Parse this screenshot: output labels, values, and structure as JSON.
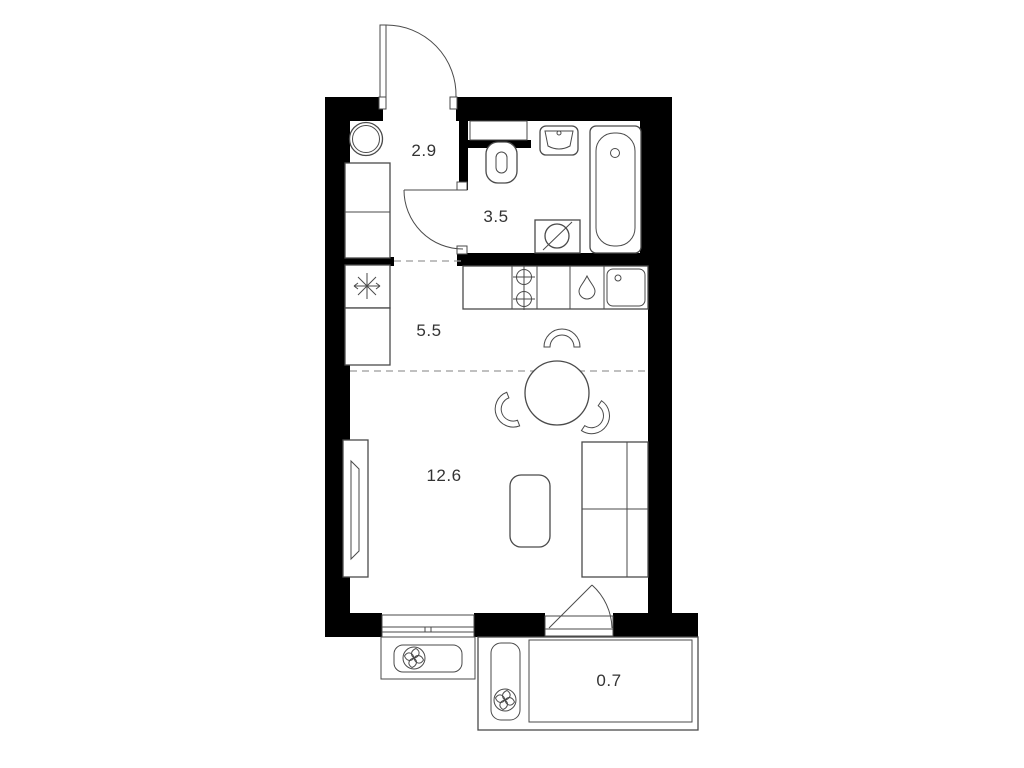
{
  "plan": {
    "rooms": [
      {
        "name": "hallway",
        "area": "2.9"
      },
      {
        "name": "bathroom",
        "area": "3.5"
      },
      {
        "name": "kitchen",
        "area": "5.5"
      },
      {
        "name": "living-room",
        "area": "12.6"
      },
      {
        "name": "balcony",
        "area": "0.7"
      }
    ],
    "colors": {
      "wall": "#000000",
      "line": "#4a4a4a",
      "dash": "#9a9a9a",
      "label": "#333333",
      "bg": "#ffffff"
    },
    "icons": {
      "refrigerator": "snowflake-icon",
      "air_conditioner": "fan-icon",
      "stove": "burner-crosshair-icon",
      "dishwasher": "water-drop-icon",
      "washing_machine": "drum-diagonal-icon"
    }
  }
}
